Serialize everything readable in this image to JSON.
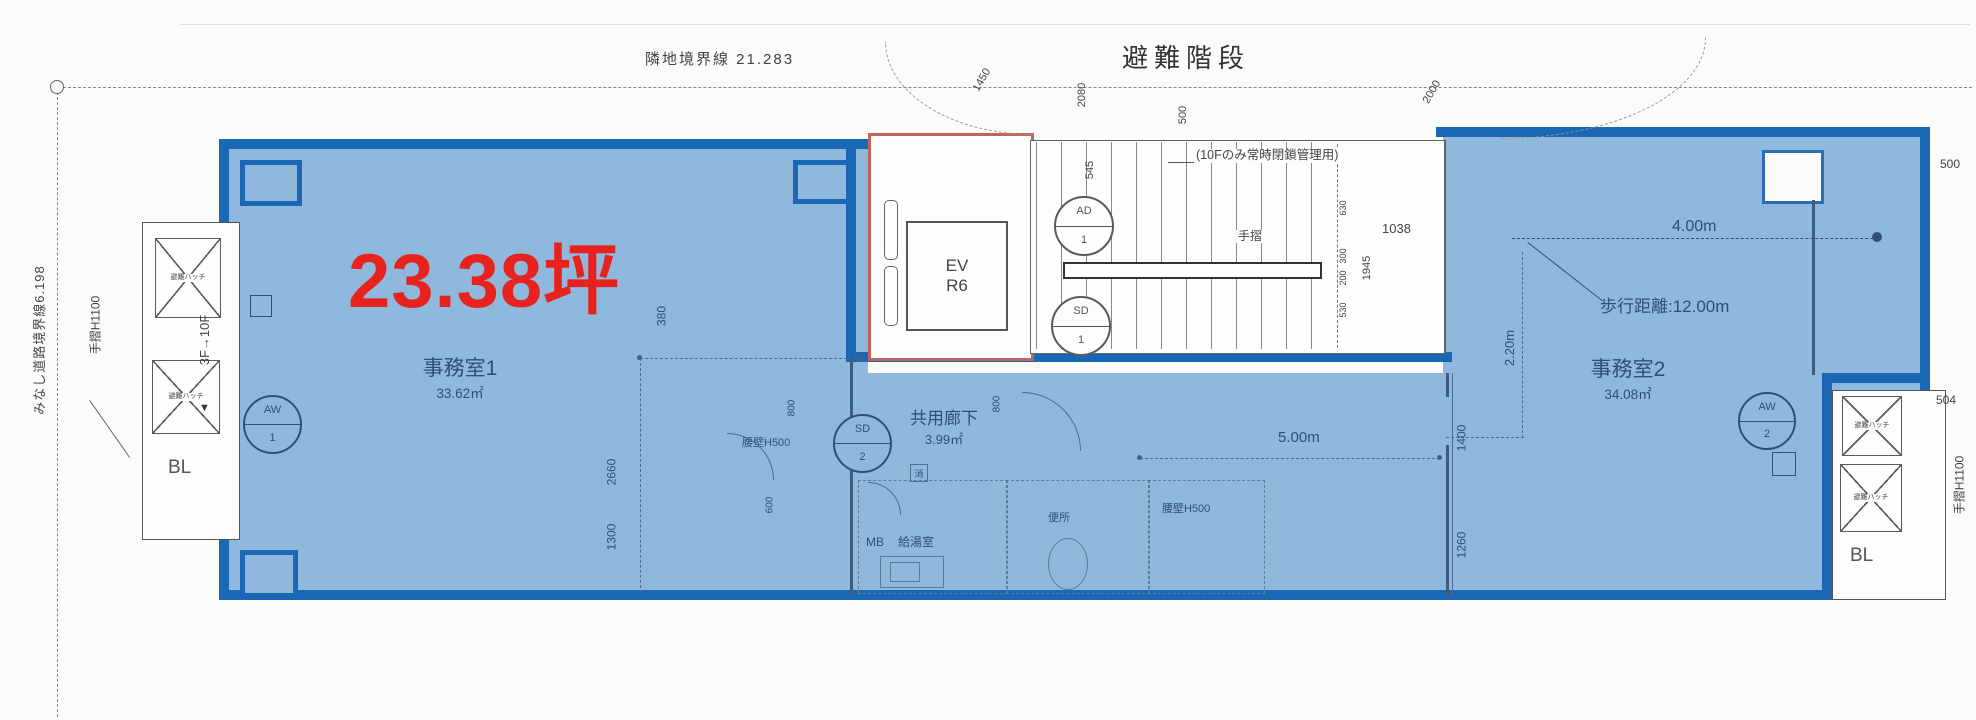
{
  "meta": {
    "type": "floor-plan",
    "highlight_fill": "#8fb9dc",
    "highlight_border": "#1a67b4",
    "accent_red": "#e8231f",
    "ev_outline_red": "#c4635c"
  },
  "site": {
    "boundary_top": "隣地境界線 21.283",
    "boundary_left": "みなし道路境界線6.198",
    "stair_title": "避難階段",
    "handrail_left": "手摺H1100",
    "handrail_right": "手摺H1100",
    "floors_range": "3F→10F",
    "down_arrow": "▼"
  },
  "highlight": {
    "area_tsubo": "23.38坪"
  },
  "rooms": {
    "office1": {
      "name": "事務室1",
      "area": "33.62㎡"
    },
    "office2": {
      "name": "事務室2",
      "area": "34.08㎡",
      "width": "4.00m",
      "walk": "歩行距離:12.00m",
      "depth": "2.20m"
    },
    "corridor": {
      "name": "共用廊下",
      "area": "3.99㎡",
      "width": "5.00m"
    },
    "kitchen": {
      "mb": "MB",
      "name": "給湯室"
    },
    "toilet": {
      "name": "便所"
    },
    "stair": {
      "note": "(10Fのみ常時閉鎖管理用)",
      "handrail": "手摺"
    },
    "elevator": {
      "line1": "EV",
      "line2": "R6"
    }
  },
  "balcony": {
    "left_label": "BL",
    "right_label": "BL",
    "hatch": "避難ハッチ"
  },
  "symbols": {
    "aw1": {
      "code": "AW",
      "num": "1"
    },
    "aw2": {
      "code": "AW",
      "num": "2"
    },
    "ad1": {
      "code": "AD",
      "num": "1"
    },
    "sd1": {
      "code": "SD",
      "num": "1"
    },
    "sd2": {
      "code": "SD",
      "num": "2"
    },
    "fire": "消"
  },
  "walls": {
    "parapet_a": "腰壁H500",
    "parapet_b": "腰壁H500"
  },
  "dims": {
    "d1450": "1450",
    "d2080": "2080",
    "d545": "545",
    "d500top": "500",
    "d2000": "2000",
    "d1038": "1038",
    "d1945": "1945",
    "d630": "630",
    "d300": "300",
    "d200": "200",
    "d530": "530",
    "d380": "380",
    "d2660": "2660",
    "d1300": "1300",
    "d600": "600",
    "d800a": "800",
    "d800b": "800",
    "d1400": "1400",
    "d1260": "1260",
    "d504": "504",
    "d500right": "500"
  }
}
